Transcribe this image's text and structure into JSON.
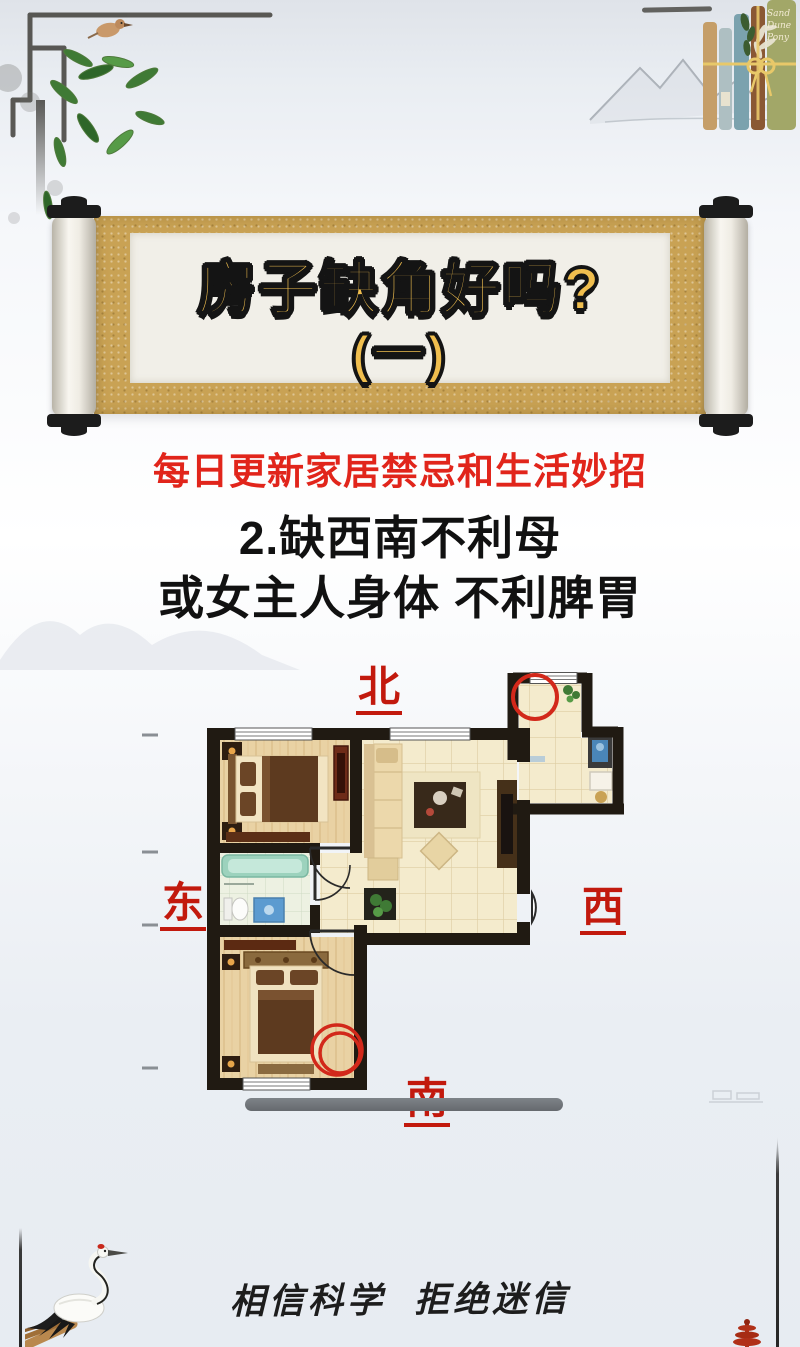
{
  "banner": {
    "title_line1": "房子缺角好吗?",
    "title_line2": "(一)"
  },
  "subtitle": "每日更新家居禁忌和生活妙招",
  "heading": {
    "line1": "2.缺西南不利母",
    "line2": "或女主人身体 不利脾胃"
  },
  "floorplan": {
    "labels": {
      "north": "北",
      "east": "东",
      "west": "西",
      "south": "南"
    },
    "annotations": [
      "missing-corner-circle-north",
      "missing-corner-circle-southwest"
    ],
    "colors": {
      "wall": "#201a12",
      "wood_floor": "#e9d2a4",
      "tile_floor": "#f4ebcd",
      "bath_tile": "#edf1e2",
      "annotation_red": "#d2281a"
    }
  },
  "footer": "相信科学 拒绝迷信",
  "decor": {
    "book_spine_text": "Sand Dune Pony"
  },
  "theme": {
    "accent_red": "#e1251b",
    "direction_red": "#c2190d",
    "title_gold": "#f0be4e",
    "scroll_gold": "#c9a254"
  }
}
